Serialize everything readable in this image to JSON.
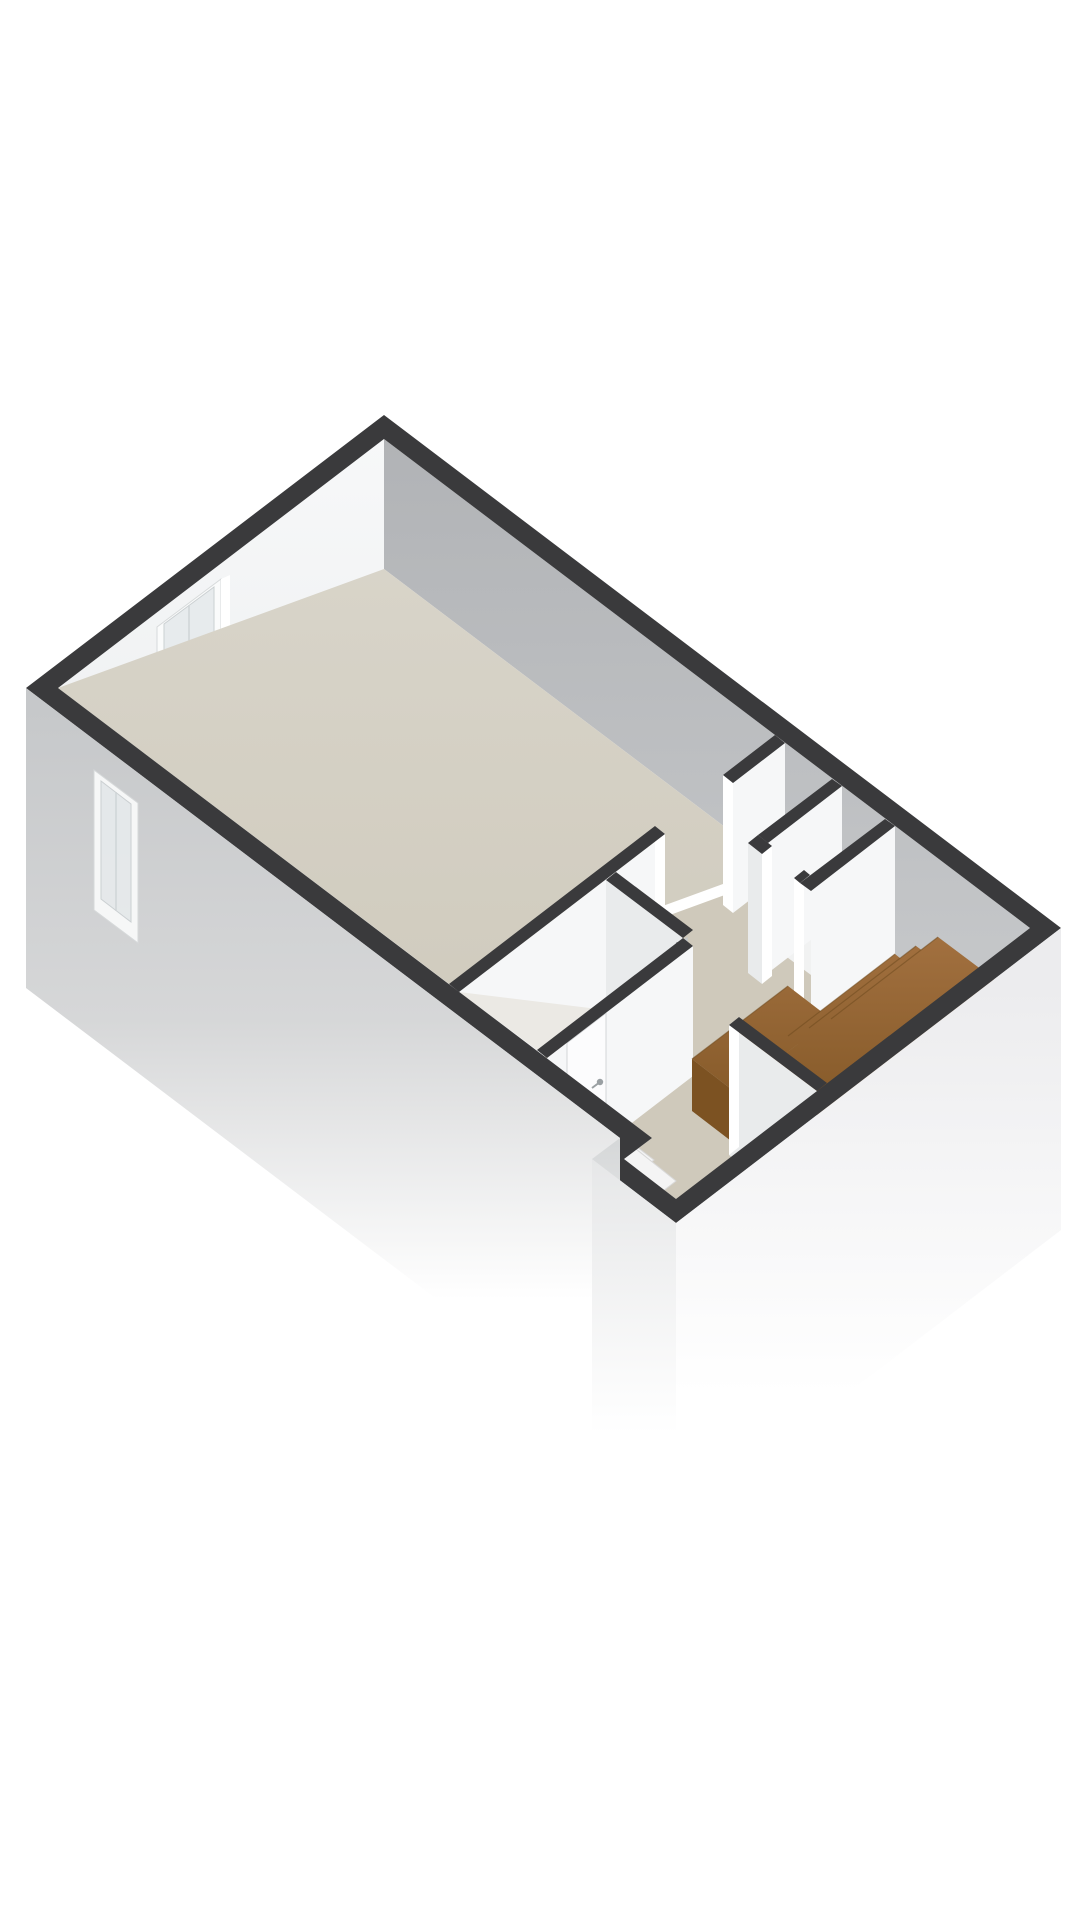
{
  "app": {
    "name": "floorplan-3d-view",
    "background": "#ffffff"
  },
  "floorplan": {
    "projection": "axonometric-3d",
    "visible_text": "",
    "rooms": [
      {
        "id": "main-room",
        "floor": "floor_main"
      },
      {
        "id": "hallway",
        "floor": "floor_hall"
      },
      {
        "id": "bathroom",
        "floor": "floor_bath"
      },
      {
        "id": "closet",
        "floor": "floor_closet"
      },
      {
        "id": "stairwell",
        "floor": "wood_top"
      },
      {
        "id": "entry-nook",
        "floor": "floor_hall"
      }
    ],
    "features": [
      "interior-window-nw-wall",
      "exterior-window-sw-wall",
      "main-room-door-opening",
      "closet-door-opening",
      "bathroom-door",
      "shower-glass-screen",
      "shower-glass-door",
      "shower-drain",
      "shower-mixer-outline",
      "stair-landing",
      "stair-steps",
      "ghost-steps-below-cut"
    ],
    "counts": {
      "windows": 2,
      "door-leaves": 1,
      "wall-openings": 3,
      "wood-steps": 2,
      "ghost-steps": 2
    }
  },
  "palette": {
    "background": "#ffffff",
    "cap": "#3a3a3c",
    "wall_white": "#f6f7f8",
    "wall_light": "#e9ebec",
    "wall_gray_top": "#b1b3b6",
    "wall_gray_bottom": "#c8cacc",
    "ext_gray": "#c6c8ca",
    "ext_light": "#ececee",
    "floor_main": "#d6d1c6",
    "floor_hall": "#cfc9bb",
    "floor_bath": "#ebe9e4",
    "floor_closet": "#f1f2f2",
    "wood_top": "#a37140",
    "wood_bottom": "#7a5120",
    "wood_side": "#7c5222",
    "glass_stroke": "#c2c8cb",
    "glass_fill": "rgba(210,219,224,0.28)",
    "ghost_step": "#f4f4f4",
    "jamb": "#ffffff",
    "handle": "#9aa0a3",
    "sliver": "#d9dbdd",
    "fixture_outline": "#c9ccce",
    "drain": "#9b9b9b"
  }
}
